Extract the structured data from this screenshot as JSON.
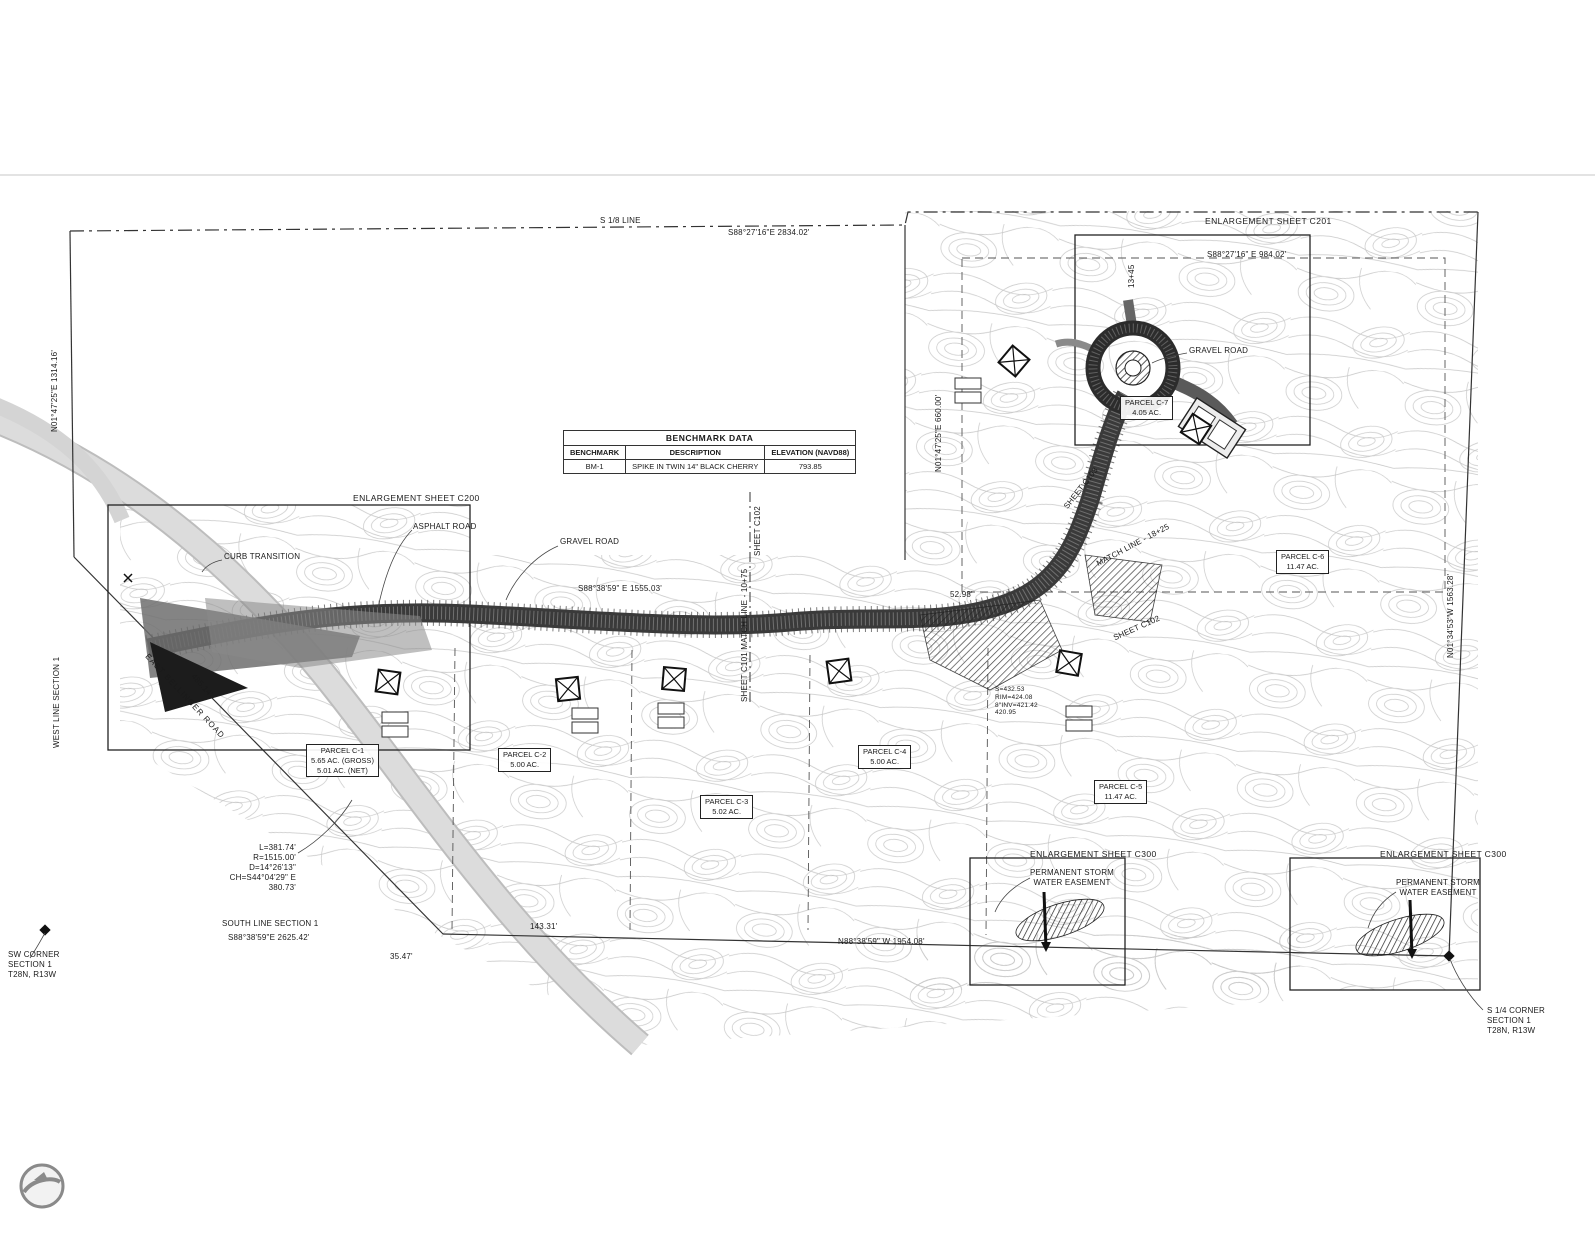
{
  "benchmark": {
    "title": "BENCHMARK DATA",
    "headers": [
      "BENCHMARK",
      "DESCRIPTION",
      "ELEVATION (NAVD88)"
    ],
    "row": [
      "BM-1",
      "SPIKE IN TWIN 14\" BLACK CHERRY",
      "793.85"
    ]
  },
  "sheets": {
    "c200": "ENLARGEMENT SHEET C200",
    "c201": "ENLARGEMENT SHEET C201",
    "c300_left": "ENLARGEMENT SHEET C300",
    "c300_right": "ENLARGEMENT SHEET C300"
  },
  "boundary": {
    "s18_line": "S 1/8 LINE",
    "north_bearing": "S88°27'16\"E  2834.02'",
    "northeast_bearing": "S88°27'16\" E  984.02'",
    "west_bearing": "N01°47'25\"E  1314.16'",
    "west_line_label": "WEST LINE  SECTION 1",
    "interior_west_bearing": "N01°47'25\"E  660.00'",
    "east_bearing": "N01°34'53\"W  1563.28'",
    "south_line_label": "SOUTH LINE  SECTION 1",
    "south_bearing": "S88°38'59\"E  2625.42'",
    "south_bearing_2": "N88°38'59\" W  1954.08'",
    "road_bearing": "S88°38'59\" E  1555.03'",
    "dim_35": "35.47'",
    "dim_143": "143.31'",
    "dim_485": "485.14'",
    "dim_52": "52.98'"
  },
  "corners": {
    "sw": "SW CORNER\nSECTION 1\nT28N, R13W",
    "s_quarter": "S 1/4 CORNER\nSECTION 1\nT28N, R13W"
  },
  "curve": {
    "text": "L=381.74'\nR=1515.00'\nD=14°26'13\"\nCH=S44°04'29\" E\n380.73'"
  },
  "roads": {
    "name": "EAST BELLINGER ROAD",
    "asphalt": "ASPHALT ROAD",
    "gravel_center": "GRAVEL ROAD",
    "gravel_northeast": "GRAVEL ROAD",
    "curb": "CURB TRANSITION"
  },
  "matchlines": {
    "sheet_c102_v": "SHEET C102",
    "c101_matchline": "SHEET C101 MATCH LINE - 10+75",
    "sheet_c103": "SHEET C103",
    "matchline_18": "MATCH LINE - 18+25",
    "sheet_c102_ne": "SHEET C102",
    "station": "13+45"
  },
  "easements": {
    "storm_left": "PERMANENT STORM\nWATER EASEMENT",
    "storm_right": "PERMANENT STORM\nWATER EASEMENT"
  },
  "structure_notes": "S=432.53\nRIM=424.08\n8\"INV=421.42\n420.95",
  "parcels": [
    {
      "name": "PARCEL C-1",
      "area": "5.65 AC. (GROSS)",
      "area2": "5.01 AC. (NET)"
    },
    {
      "name": "PARCEL C-2",
      "area": "5.00 AC."
    },
    {
      "name": "PARCEL C-3",
      "area": "5.02 AC."
    },
    {
      "name": "PARCEL C-4",
      "area": "5.00 AC."
    },
    {
      "name": "PARCEL C-5",
      "area": "11.47 AC."
    },
    {
      "name": "PARCEL C-6",
      "area": "11.47 AC."
    },
    {
      "name": "PARCEL C-7",
      "area": "4.05 AC."
    }
  ],
  "colors": {
    "contour": "#c7c7c7",
    "linework": "#222222",
    "road_fill": "#3a3a3a",
    "existing_road": "#d8d8d8"
  }
}
